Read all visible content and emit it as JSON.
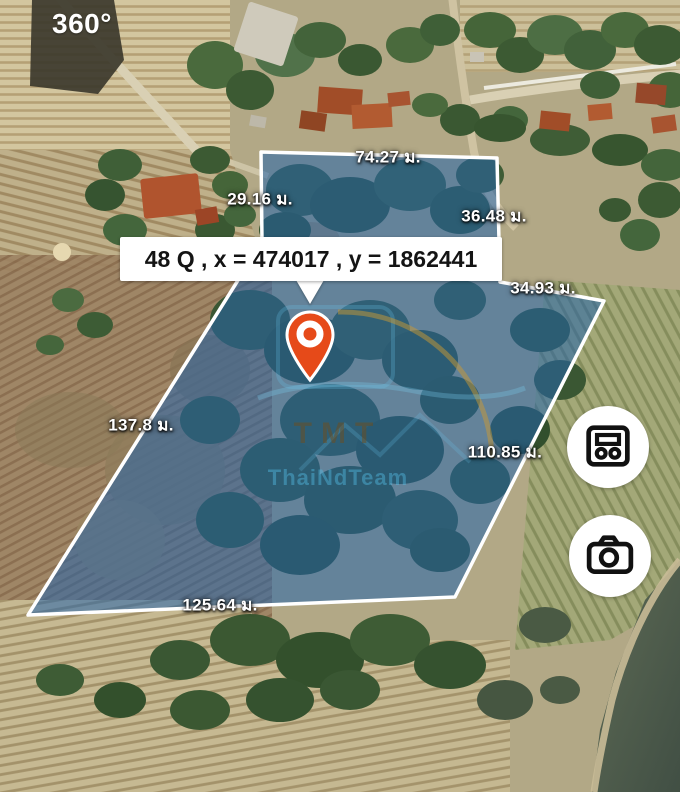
{
  "map_view": {
    "type": "satellite-parcel-map",
    "mode_badge": "360°",
    "watermark": {
      "brand": "TMT",
      "subtitle": "ThaiNdTeam"
    },
    "pin": {
      "color": "#e64a19"
    },
    "parcel": {
      "coordinate_callout": "48 Q , x = 474017 , y = 1862441",
      "fill_color": "#2565ab",
      "stroke_color": "#ffffff",
      "unit": "ม.",
      "measurements": [
        {
          "side": "top",
          "label": "74.27 ม."
        },
        {
          "side": "upper-left",
          "label": "29.16 ม."
        },
        {
          "side": "upper-right",
          "label": "36.48 ม."
        },
        {
          "side": "mid-right",
          "label": "34.93 ม."
        },
        {
          "side": "left",
          "label": "137.8 ม."
        },
        {
          "side": "right",
          "label": "110.85 ม."
        },
        {
          "side": "bottom",
          "label": "125.64 ม."
        }
      ]
    }
  },
  "controls": {
    "buttons": [
      {
        "id": "area-summary",
        "icon": "meter-card-icon"
      },
      {
        "id": "camera",
        "icon": "camera-icon"
      }
    ]
  }
}
